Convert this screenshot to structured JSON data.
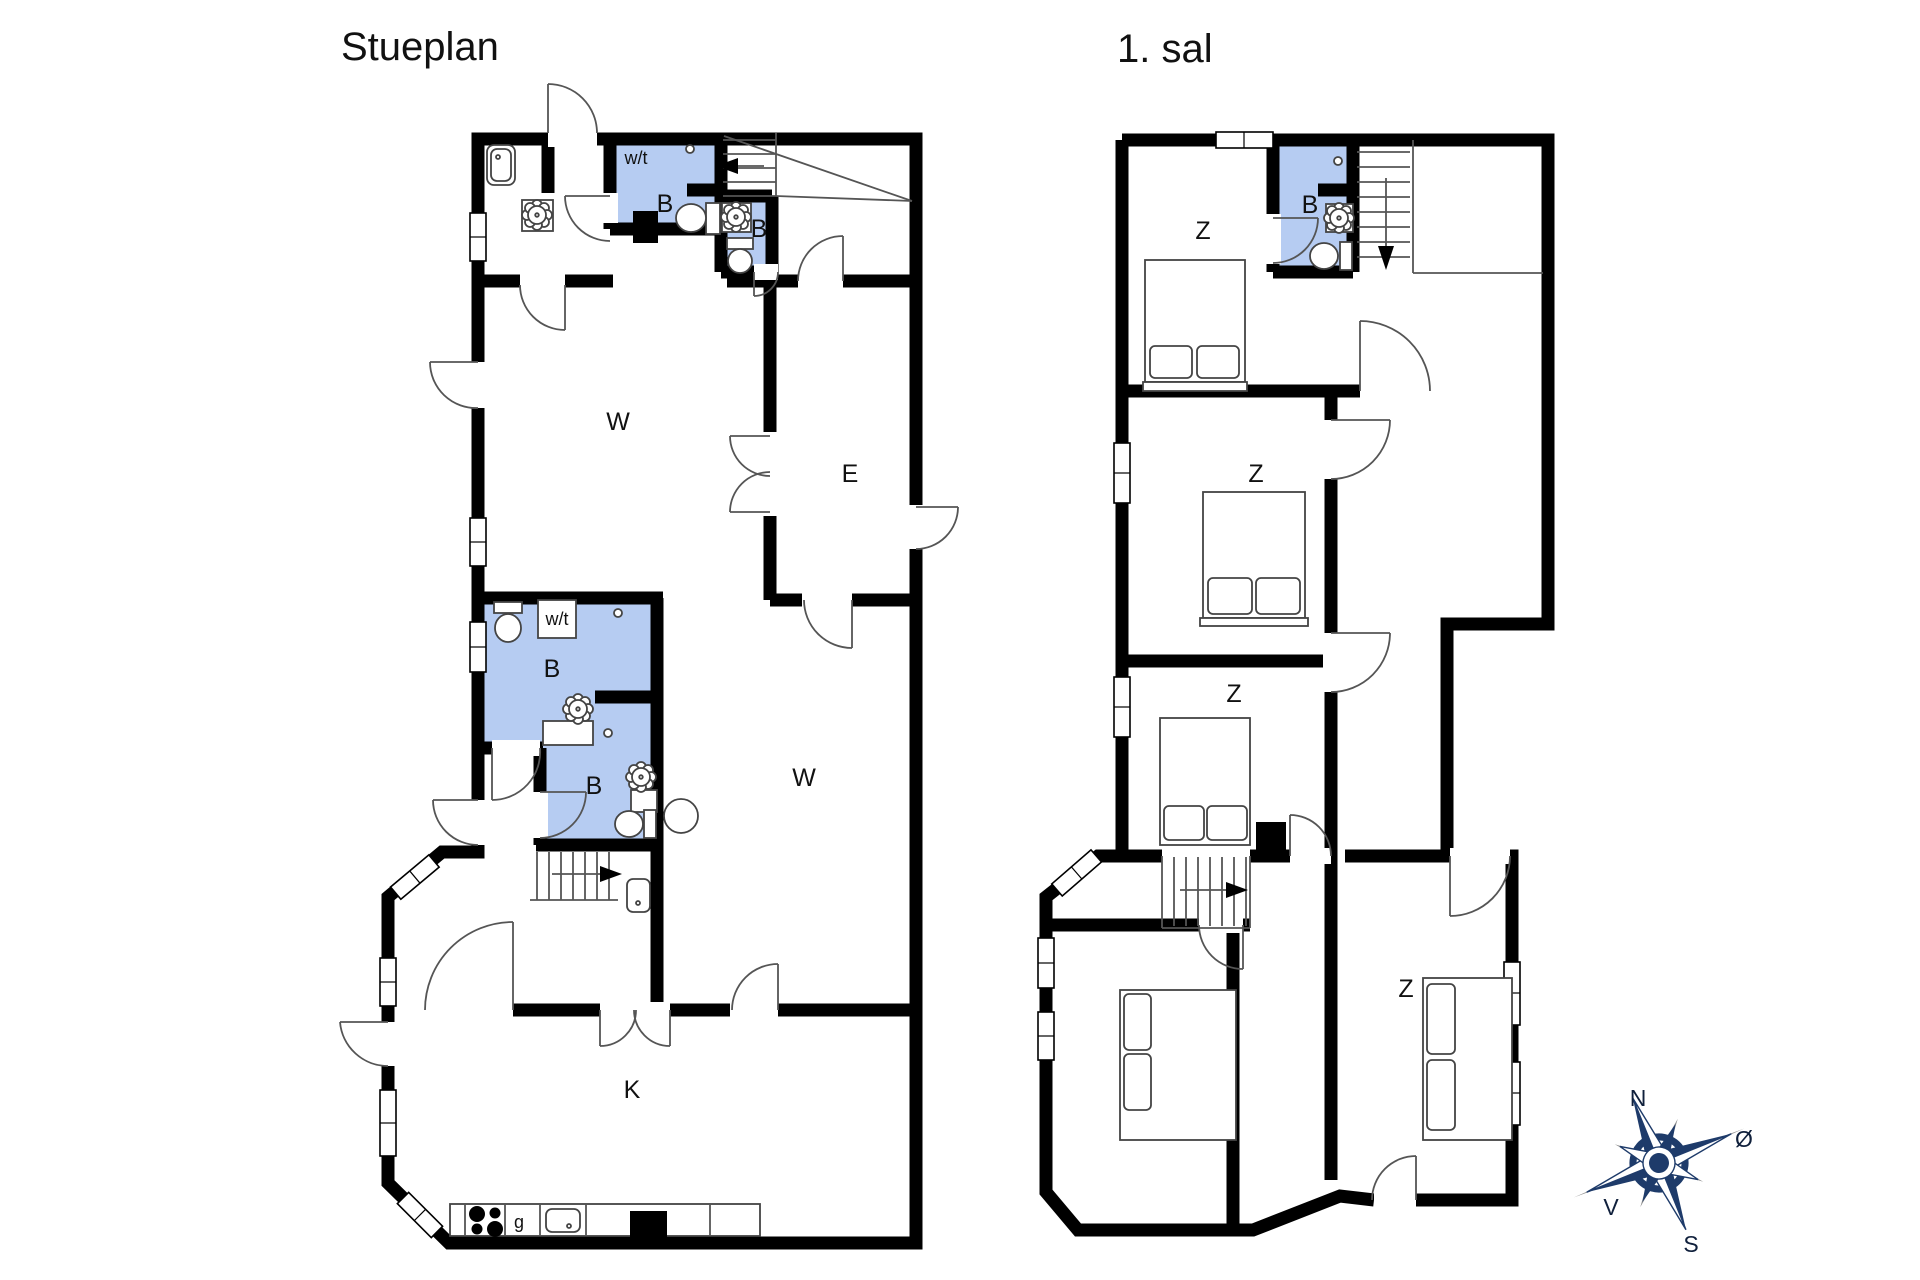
{
  "ground_floor": {
    "title": "Stueplan",
    "labels": {
      "wt1": "w/t",
      "bath1": "B",
      "bath2": "B",
      "living1": "W",
      "entry": "E",
      "wt2": "w/t",
      "bath3": "B",
      "bath4": "B",
      "living2": "W",
      "kitchen": "K",
      "stove": "g"
    }
  },
  "first_floor": {
    "title": "1. sal",
    "labels": {
      "bedroom1": "Z",
      "bath": "B",
      "bedroom2": "Z",
      "bedroom3": "Z",
      "bedroom4": "Z"
    }
  },
  "compass": {
    "north": "N",
    "south": "S",
    "east": "Ø",
    "west": "V"
  },
  "colors": {
    "bathroom_fill": "#b6ccf2",
    "wall": "#000000",
    "fixture_line": "#555555",
    "compass_navy": "#1e3b6a"
  }
}
